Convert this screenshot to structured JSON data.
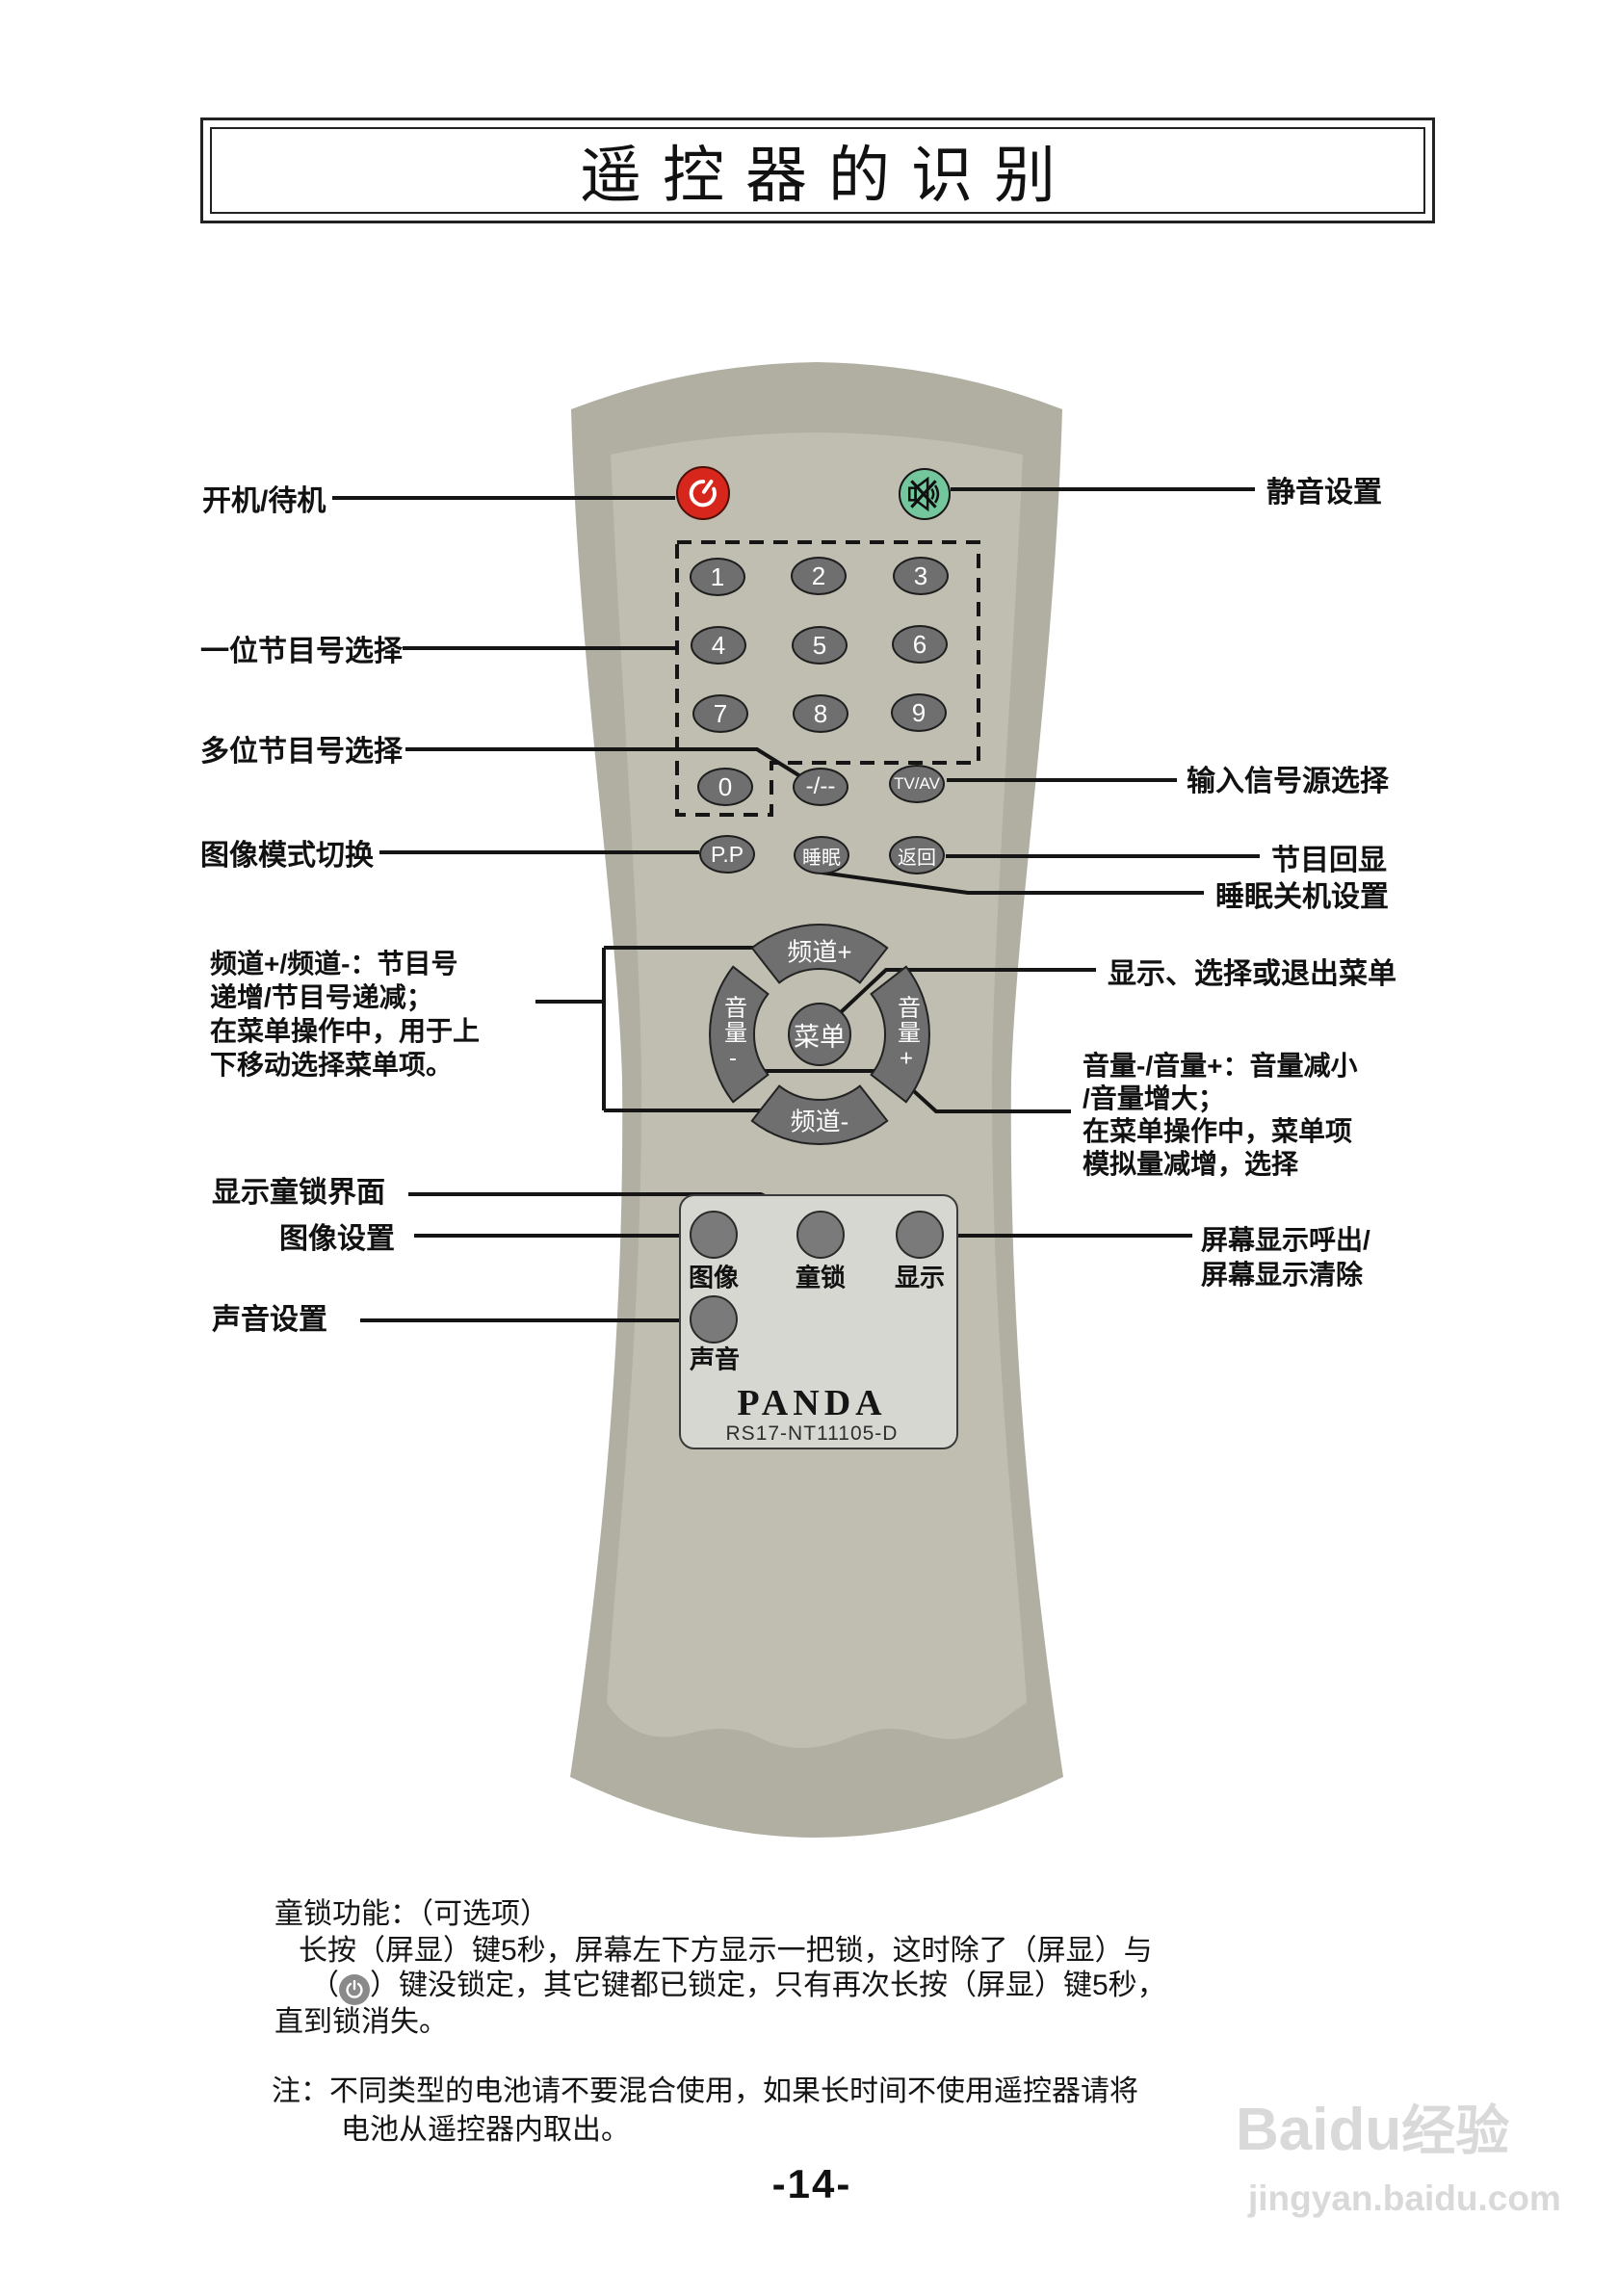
{
  "title": {
    "text": "遥控器的识别"
  },
  "remote": {
    "brand": "PANDA",
    "model": "RS17-NT11105-D",
    "icons": {
      "power": "power-icon",
      "mute": "mute-speaker-x-icon"
    },
    "digits": [
      "1",
      "2",
      "3",
      "4",
      "5",
      "6",
      "7",
      "8",
      "9",
      "0"
    ],
    "dash_button": "-/--",
    "tvav_button": "TV/AV",
    "pp_button": "P.P",
    "sleep_button": "睡眠",
    "return_button": "返回",
    "channel_up": "频道+",
    "channel_down": "频道-",
    "menu_button": "菜单",
    "volume_down": "音量-",
    "volume_up": "音量+",
    "picture_button": "图像",
    "childlock_button": "童锁",
    "display_button": "显示",
    "sound_button": "声音"
  },
  "left_labels": {
    "power": "开机/待机",
    "single_digit": "一位节目号选择",
    "multi_digit": "多位节目号选择",
    "picture_mode": "图像模式切换",
    "channel_lines": [
      "频道+/频道-：节目号",
      "递增/节目号递减；",
      "在菜单操作中，用于上",
      "下移动选择菜单项。"
    ],
    "childlock": "显示童锁界面",
    "picture_set": "图像设置",
    "sound_set": "声音设置"
  },
  "right_labels": {
    "mute": "静音设置",
    "input_source": "输入信号源选择",
    "program_recall": "节目回显",
    "sleep": "睡眠关机设置",
    "menu": "显示、选择或退出菜单",
    "volume_lines": [
      "音量-/音量+：音量减小",
      "/音量增大；",
      "在菜单操作中，菜单项",
      "模拟量减增，选择"
    ],
    "osd_lines": [
      "屏幕显示呼出/",
      "屏幕显示清除"
    ]
  },
  "footer": {
    "childlock_line1": "童锁功能：（可选项）",
    "childlock_line2": "长按（屏显）键5秒，屏幕左下方显示一把锁，这时除了（屏显）与",
    "childlock_line3_pre": "（",
    "childlock_line3_post": "）键没锁定，其它键都已锁定，只有再次长按（屏显）键5秒，",
    "childlock_line4": "直到锁消失。",
    "battery_line1": "注：不同类型的电池请不要混合使用，如果长时间不使用遥控器请将",
    "battery_line2": "电池从遥控器内取出。",
    "page_number": "-14-"
  },
  "watermark": {
    "brand": "Baidu",
    "suffix": "经验",
    "url": "jingyan.baidu.com"
  },
  "colors": {
    "power_red": "#d7261b",
    "mute_green": "#74c79c",
    "body_outer": "#b0afa1",
    "body_inner": "#bfbeb0",
    "button_gray": "#6f6f6f",
    "panel_gray": "#d7d7d2"
  }
}
